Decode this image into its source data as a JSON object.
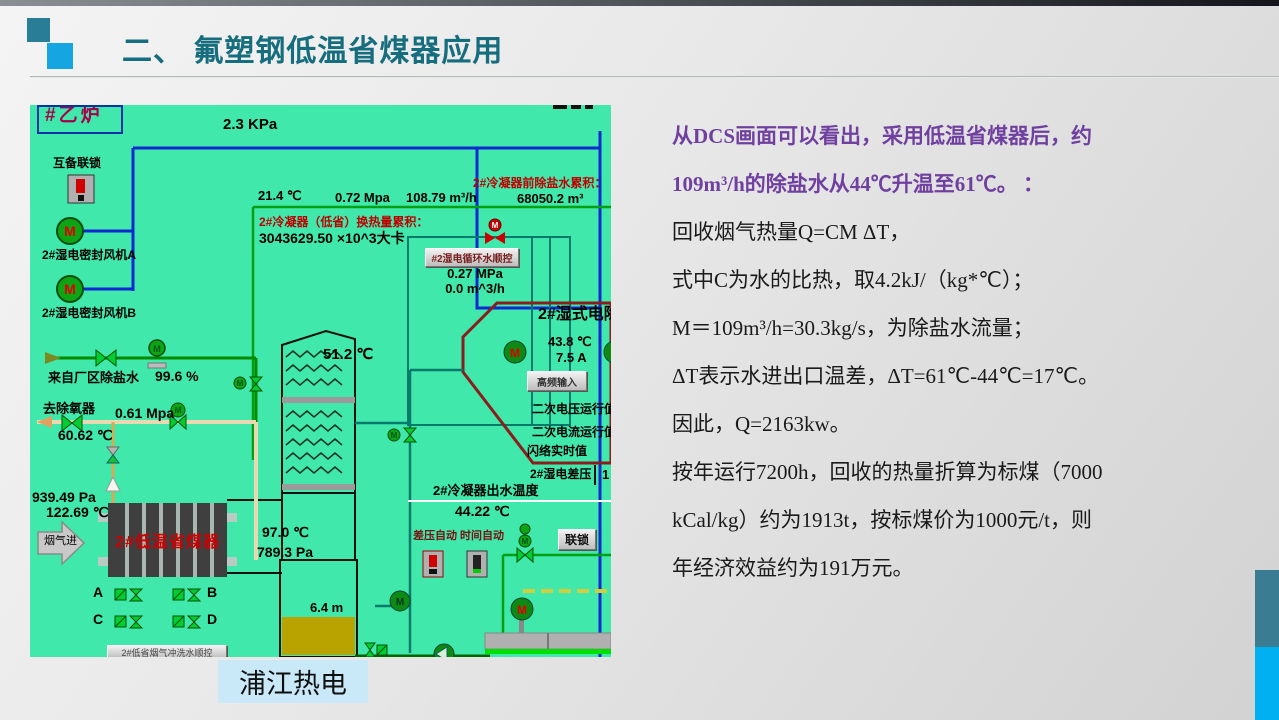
{
  "slide": {
    "title": "二、 氟塑钢低温省煤器应用",
    "caption": "浦江热电"
  },
  "colors": {
    "title_teal": "#156d7e",
    "body_purple": "#7040a0",
    "dcs_background": "#41e8ac",
    "accent_bar_teal": "#3a7d93",
    "accent_bar_blue": "#00b0f0",
    "caption_background": "#c9e9f8",
    "economizer_text_red": "#cc0000"
  },
  "body": {
    "lines": [
      {
        "text": "从DCS画面可以看出，采用低温省煤器后，约",
        "emphasis": "purple"
      },
      {
        "text": "109m³/h的除盐水从44℃升温至61℃。 ：",
        "emphasis": "purple"
      },
      {
        "text": "回收烟气热量Q=CM ΔT，",
        "emphasis": "normal"
      },
      {
        "text": "式中C为水的比热，取4.2kJ/（kg*℃）；",
        "emphasis": "normal"
      },
      {
        "text": "M＝109m³/h=30.3kg/s，为除盐水流量；",
        "emphasis": "normal"
      },
      {
        "text": "ΔT表示水进出口温差，ΔT=61℃-44℃=17℃。",
        "emphasis": "normal"
      },
      {
        "text": "因此，Q=2163kw。",
        "emphasis": "normal"
      },
      {
        "text": "按年运行7200h，回收的热量折算为标煤（7000",
        "emphasis": "normal"
      },
      {
        "text": "kCal/kg）约为1913t，按标煤价为1000元/t，则",
        "emphasis": "normal"
      },
      {
        "text": "年经济效益约为191万元。",
        "emphasis": "normal"
      }
    ]
  },
  "dcs": {
    "boiler": "#乙炉",
    "top_pressure": "2.3 KPa",
    "interlock_label": "互备联锁",
    "fan_a": "2#湿电密封风机A",
    "fan_b": "2#湿电密封风机B",
    "pre_desalt_accum_label": "2#冷凝器前除盐水累积：",
    "pre_desalt_accum_value": "68050.2 m³",
    "temp_in": "21.4 ℃",
    "pressure_in": "0.72 Mpa",
    "flow_in": "108.79 m³/h",
    "heat_accum_label": "2#冷凝器（低省）换热量累积：",
    "heat_accum_value": "3043629.50 ×10^3大卡",
    "seq_button": "#2湿电循环水顺控",
    "spray_pressure": "0.27 MPa",
    "spray_flow": "0.0 m^3/h",
    "wesp_title": "2#湿式电除尘",
    "wesp_temp": "43.8 ℃",
    "wesp_current": "7.5 A",
    "hf_button": "高频输入",
    "sec_voltage": "二次电压运行值",
    "sec_current": "二次电流运行值",
    "flash_value": "闪络实时值",
    "wesp_dp_label": "2#湿电差压",
    "wesp_dp_value": "1",
    "mid_temp": "51.2 ℃",
    "inlet_water_label": "来自厂区除盐水",
    "valve_open": "99.6 %",
    "deaerator_label": "去除氧器",
    "deaerator_pressure": "0.61 Mpa",
    "deaerator_temp": "60.62 ℃",
    "gas_in_pressure": "939.49 Pa",
    "gas_in_temp": "122.69 ℃",
    "flue_gas_label": "烟气进",
    "economizer_label": "2#低温省煤器",
    "out_temp": "97.0 ℃",
    "out_pressure": "789.3 Pa",
    "tank_level": "6.4 m",
    "outlet_temp_label": "2#冷凝器出水温度",
    "outlet_temp_value": "44.22 ℃",
    "dp_auto_label": "差压自动",
    "time_auto_label": "时间自动",
    "interlock_button": "联锁",
    "flush_button": "2#低省烟气冲洗水顺控",
    "valve_a": "A",
    "valve_b": "B",
    "valve_c": "C",
    "valve_d": "D"
  }
}
